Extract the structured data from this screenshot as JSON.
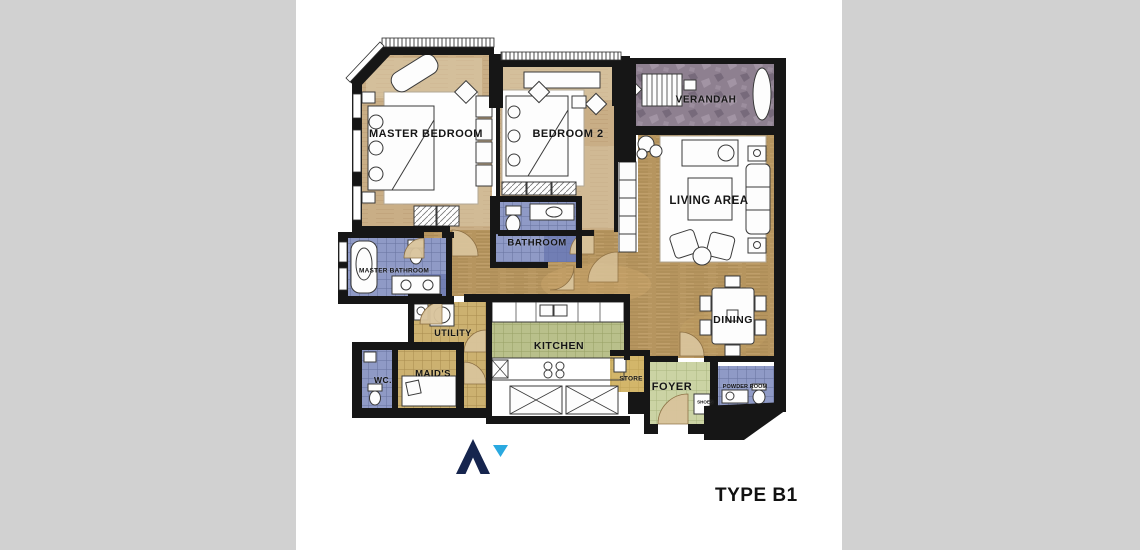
{
  "page": {
    "side_matte_color": "#d1d1d1",
    "sheet_color": "#ffffff"
  },
  "plan": {
    "type_label": "TYPE B1",
    "rooms": [
      {
        "name": "master-bedroom",
        "label": "MASTER BEDROOM"
      },
      {
        "name": "bedroom-2",
        "label": "BEDROOM 2"
      },
      {
        "name": "verandah",
        "label": "VERANDAH"
      },
      {
        "name": "living-area",
        "label": "LIVING AREA"
      },
      {
        "name": "bathroom",
        "label": "BATHROOM"
      },
      {
        "name": "master-bathroom",
        "label": "MASTER BATHROOM"
      },
      {
        "name": "utility",
        "label": "UTILITY"
      },
      {
        "name": "kitchen",
        "label": "KITCHEN"
      },
      {
        "name": "dining",
        "label": "DINING"
      },
      {
        "name": "wc",
        "label": "WC."
      },
      {
        "name": "maids",
        "label": "MAID'S"
      },
      {
        "name": "store",
        "label": "STORE"
      },
      {
        "name": "foyer",
        "label": "FOYER"
      },
      {
        "name": "powder-room",
        "label": "POWDER ROOM"
      },
      {
        "name": "shoes",
        "label": "SHOES"
      }
    ],
    "colors": {
      "wall": "#161616",
      "wood_floor": "#b6955f",
      "bedroom_floor": "#c9ae86",
      "verandah_stone": "#8e8090",
      "bath_tile": "#8f9ac6",
      "khaki_tile": "#ccb170",
      "kitchen_tile": "#b9c08b",
      "foyer_tile": "#cbd3a4"
    }
  },
  "logo": {
    "arrow_color": "#16254e",
    "triangle_color": "#2aa9e0"
  }
}
